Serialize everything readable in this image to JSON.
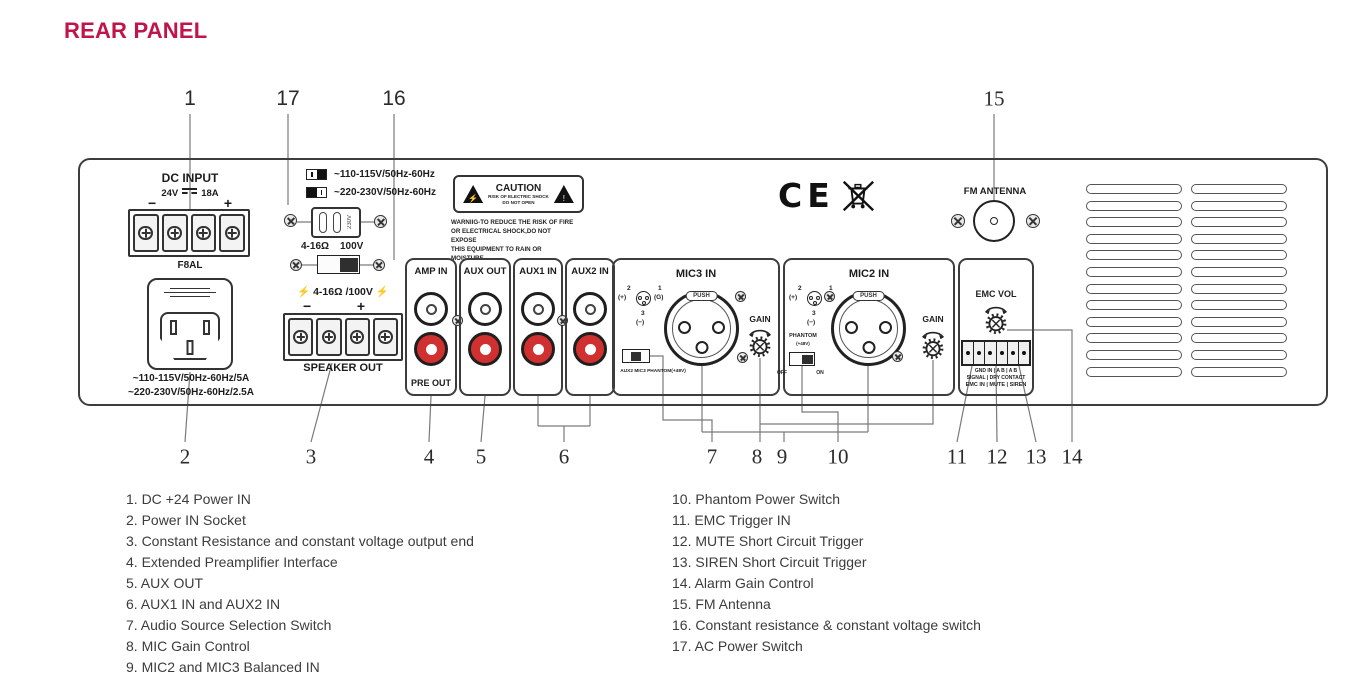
{
  "title": "REAR PANEL",
  "colors": {
    "accent": "#c0154a",
    "jack_red": "#d03030",
    "leader": "#7a7a7a"
  },
  "panel": {
    "dc_input": {
      "title": "DC INPUT",
      "volts": "24V",
      "amps": "18A",
      "minus": "−",
      "plus": "+",
      "fuse_label": "F8AL"
    },
    "power_socket": {
      "rating1": "~110-115V/50Hz-60Hz/5A",
      "rating2": "~220-230V/50Hz-60Hz/2.5A"
    },
    "voltage_selector": {
      "option1": "~110-115V/50Hz-60Hz",
      "option2": "~220-230V/50Hz-60Hz",
      "cartridge_label": "230V",
      "impedance_label": "4-16Ω",
      "voltage_label": "100V"
    },
    "speaker_out": {
      "bolt": "⚡",
      "rating": "4-16Ω /100V",
      "minus": "−",
      "plus": "+",
      "label": "SPEAKER OUT"
    },
    "caution_label": {
      "title": "CAUTION",
      "line1": "RISK OF ELECTRIC SHOCK",
      "line2": "DO NOT OPEN",
      "bolt": "⚡",
      "bang": "!",
      "warn1": "WARNIIG-TO REDUCE THE RISK OF FIRE",
      "warn2": "OR ELECTRICAL SHOCK,DO NOT EXPOSE",
      "warn3": "THIS EQUIPMENT TO RAIN OR MOISTURE."
    },
    "certifications": {
      "ce": "CE"
    },
    "fm_antenna": {
      "label": "FM ANTENNA"
    },
    "rca": {
      "amp_in": {
        "label": "AMP IN",
        "sub_label": "PRE OUT"
      },
      "aux_out": {
        "label": "AUX OUT"
      },
      "aux1_in": {
        "label": "AUX1 IN"
      },
      "aux2_in": {
        "label": "AUX2 IN"
      }
    },
    "xlr_pinout": {
      "pin2": "2",
      "pin2_sign": "(+)",
      "pin1": "1",
      "pin1_sign": "(G)",
      "pin3": "3",
      "pin3_sign": "(−)"
    },
    "mic3": {
      "label": "MIC3 IN",
      "push": "PUSH",
      "switch_options": "AUX2 MIC3 PHANTOM(+48V)",
      "gain_label": "GAIN"
    },
    "mic2": {
      "label": "MIC2 IN",
      "push": "PUSH",
      "phantom_line1": "PHANTOM",
      "phantom_line2": "(+48V)",
      "off": "OFF",
      "on": "ON",
      "gain_label": "GAIN"
    },
    "emc": {
      "label": "EMC VOL",
      "pins_row": "GND IN | A B | A B",
      "signal_row": "SIGNAL | DRY CONTACT",
      "function_row": "EMC IN | MUTE | SIREN"
    }
  },
  "callouts": {
    "top": [
      {
        "n": "1",
        "x": 190
      },
      {
        "n": "17",
        "x": 288
      },
      {
        "n": "16",
        "x": 394
      },
      {
        "n": "15",
        "x": 994,
        "serif": true
      }
    ],
    "bottom": [
      {
        "n": "2",
        "x": 185
      },
      {
        "n": "3",
        "x": 311
      },
      {
        "n": "4",
        "x": 429
      },
      {
        "n": "5",
        "x": 481
      },
      {
        "n": "6",
        "x": 564
      },
      {
        "n": "7",
        "x": 712
      },
      {
        "n": "8",
        "x": 757
      },
      {
        "n": "9",
        "x": 782
      },
      {
        "n": "10",
        "x": 838
      },
      {
        "n": "11",
        "x": 957
      },
      {
        "n": "12",
        "x": 997
      },
      {
        "n": "13",
        "x": 1036
      },
      {
        "n": "14",
        "x": 1072
      }
    ]
  },
  "legend": {
    "left": [
      "1. DC +24 Power IN",
      "2. Power IN Socket",
      "3. Constant Resistance and constant voltage output end",
      "4. Extended Preamplifier Interface",
      "5. AUX OUT",
      "6. AUX1 IN and AUX2 IN",
      "7. Audio Source Selection Switch",
      "8. MIC Gain Control",
      "9. MIC2 and MIC3 Balanced IN"
    ],
    "right": [
      "10. Phantom Power Switch",
      "11. EMC Trigger IN",
      "12. MUTE Short Circuit Trigger",
      "13. SIREN Short Circuit Trigger",
      "14. Alarm Gain Control",
      "15. FM Antenna",
      "16. Constant resistance & constant voltage switch",
      "17. AC Power Switch"
    ]
  }
}
